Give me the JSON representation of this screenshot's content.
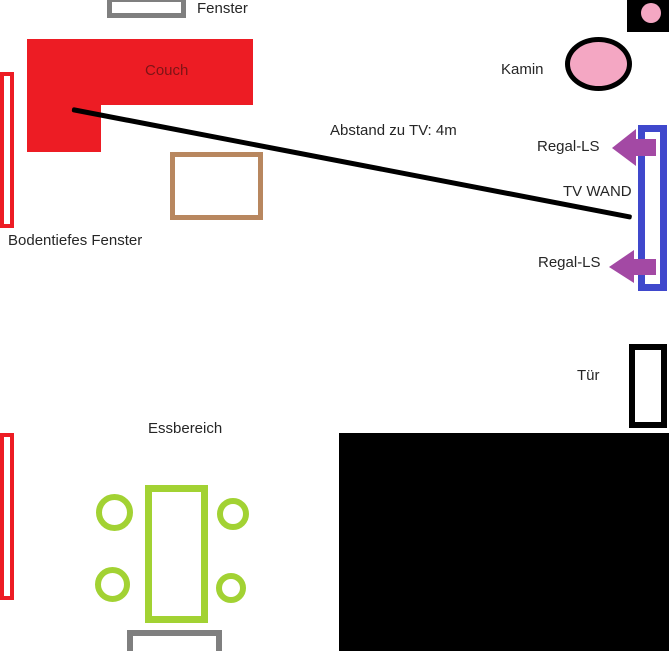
{
  "floor_plan": {
    "labels": {
      "window_top": "Fenster",
      "couch": "Couch",
      "fireplace": "Kamin",
      "tv_distance": "Abstand zu TV: 4m",
      "shelf_speaker_top": "Regal-LS",
      "tv_wall": "TV WAND",
      "shelf_speaker_bottom": "Regal-LS",
      "floor_window": "Bodentiefes Fenster",
      "door": "Tür",
      "dining_area": "Essbereich"
    },
    "colors": {
      "red": "#ed1c24",
      "couch_text": "#7d1416",
      "pink": "#f4a7c3",
      "gray": "#7f7f7f",
      "purple": "#a349a4",
      "blue": "#3f48cc",
      "green": "#a2d233",
      "brown": "#b8875f",
      "text": "#262626"
    }
  }
}
